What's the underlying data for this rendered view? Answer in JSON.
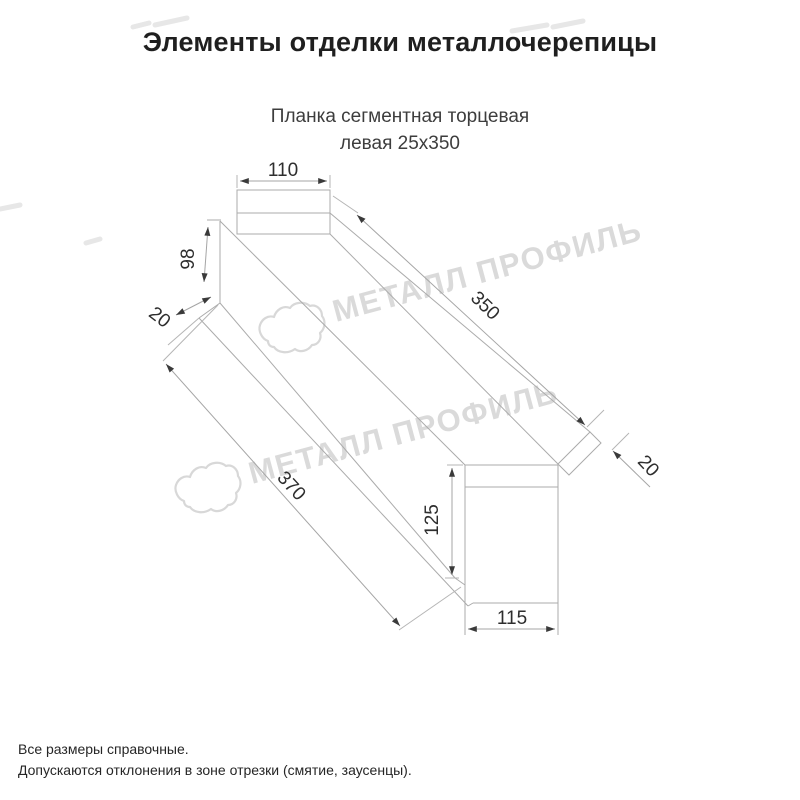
{
  "page": {
    "background": "#ffffff"
  },
  "header": {
    "title": "Элементы отделки металлочерепицы",
    "title_color": "#1f1f1f"
  },
  "product": {
    "name_line1": "Планка сегментная торцевая",
    "name_line2": "левая 25x350",
    "color": "#3d3d3d"
  },
  "drawing": {
    "type": "dimensioned isometric technical drawing of left segmental end strip",
    "dimensions": {
      "top_width": "110",
      "left_height": "98",
      "left_fold": "20",
      "top_length": "350",
      "right_fold": "20",
      "bottom_length": "370",
      "end_height": "125",
      "end_width": "115"
    },
    "line_color": "#ababab",
    "label_color": "#2e2e2e",
    "arrow_color": "#3a3a3a",
    "watermark": {
      "text": "МЕТАЛЛ ПРОФИЛЬ",
      "color": "#dadada"
    }
  },
  "footer": {
    "note1": "Все размеры справочные.",
    "note2": "Допускаются отклонения в зоне отрезки (смятие, заусенцы)."
  }
}
